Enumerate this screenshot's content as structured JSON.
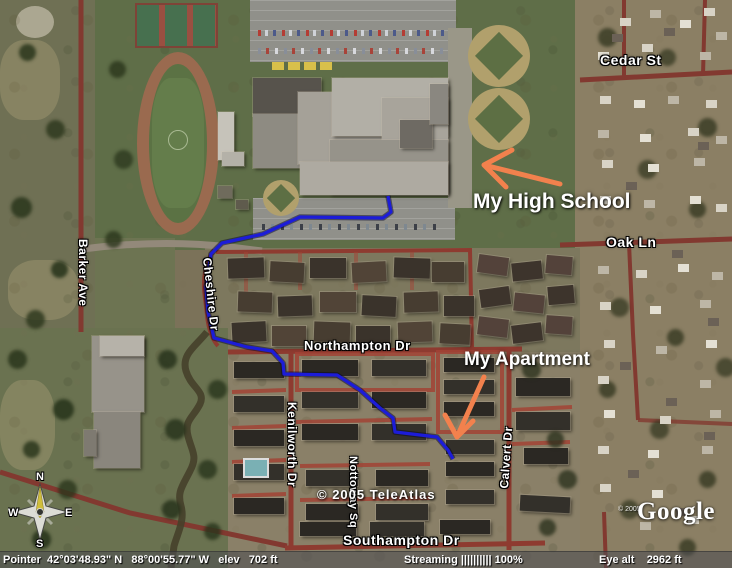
{
  "map": {
    "street_labels": {
      "cedar": "Cedar St",
      "oak": "Oak Ln",
      "barker": "Barker Ave",
      "cheshire": "Cheshire Dr",
      "northampton": "Northampton Dr",
      "kenilworth": "Kenilworth Dr",
      "nottoway": "Nottoway Sq",
      "calvert": "Calvert Dr",
      "southampton": "Southampton Dr"
    },
    "annotations": {
      "high_school": "My High School",
      "apartment": "My Apartment",
      "color": "#f2814d"
    },
    "route_color": "#1c1cd8",
    "copyright_imagery": "© 2005 TeleAtlas",
    "google_logo": {
      "year": "© 2005",
      "text": "Google"
    },
    "compass": {
      "n": "N",
      "e": "E",
      "s": "S",
      "w": "W"
    }
  },
  "status_bar": {
    "pointer": "Pointer  42°03'48.93\" N   88°00'55.77\" W   elev   702 ft",
    "streaming": "Streaming |||||||||| 100%",
    "eye_alt": "Eye alt    2962 ft"
  }
}
